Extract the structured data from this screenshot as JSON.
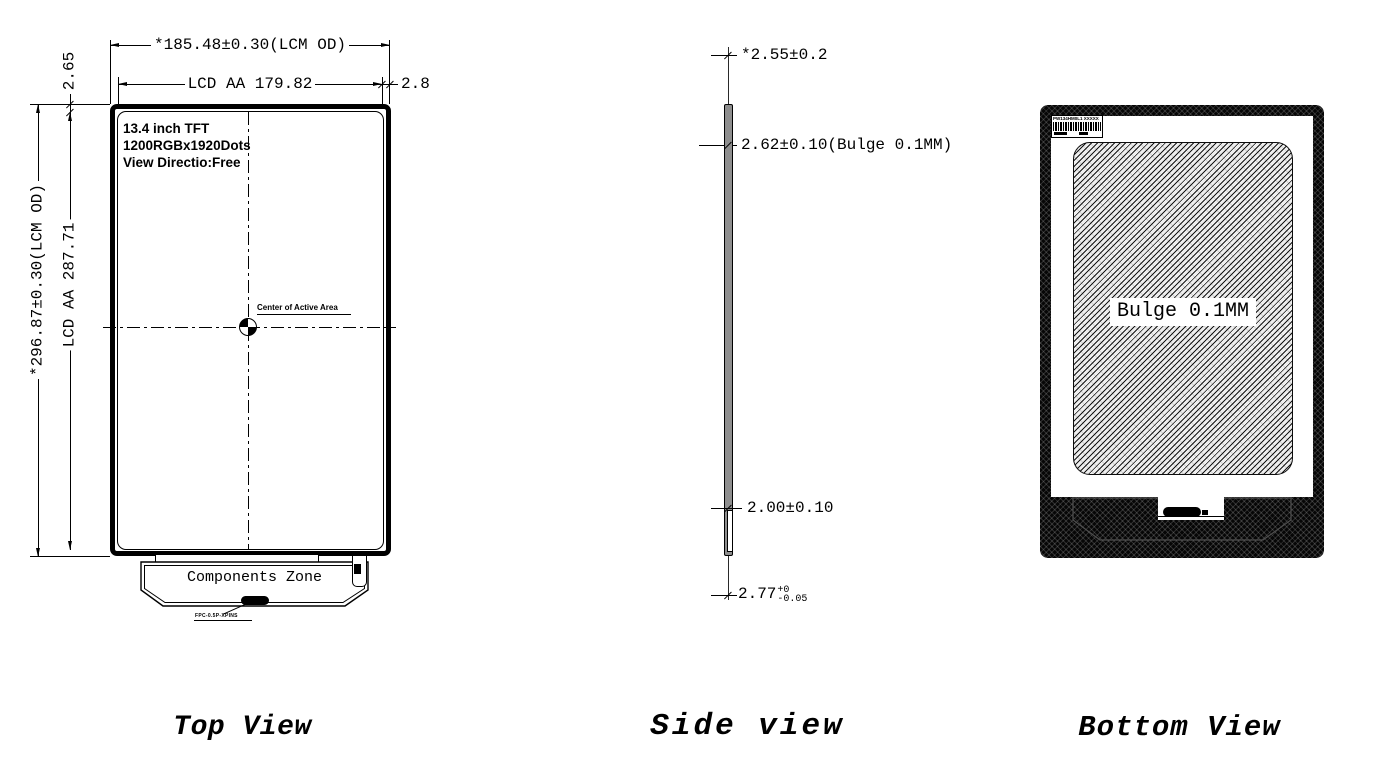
{
  "page": {
    "background": "#ffffff",
    "line_color": "#000000"
  },
  "top_view": {
    "title": "Top View",
    "dims": {
      "width_od": "*185.48±0.30(LCM OD)",
      "width_aa": "LCD AA  179.82",
      "right_margin": "2.8",
      "top_margin": "2.65",
      "height_od": "*296.87±0.30(LCM OD)",
      "height_aa": "LCD AA  287.71"
    },
    "panel_info": {
      "line1": "13.4 inch TFT",
      "line2": "1200RGBx1920Dots",
      "line3": "View Directio:Free"
    },
    "center_label": "Center of Active Area",
    "components_zone": "Components Zone",
    "connector_label": "FPC-0.5P-XPINS"
  },
  "side_view": {
    "title": "Side view",
    "dims": {
      "top_thickness": "*2.55±0.2",
      "bulge": "2.62±0.10(Bulge 0.1MM)",
      "lower_thickness": "2.00±0.10",
      "total": "2.77",
      "total_tol_plus": "+0",
      "total_tol_minus": "-0.05"
    }
  },
  "bottom_view": {
    "title": "Bottom View",
    "bulge_label": "Bulge 0.1MM",
    "barcode_text": "PW134HM0L1 XXXXX"
  }
}
